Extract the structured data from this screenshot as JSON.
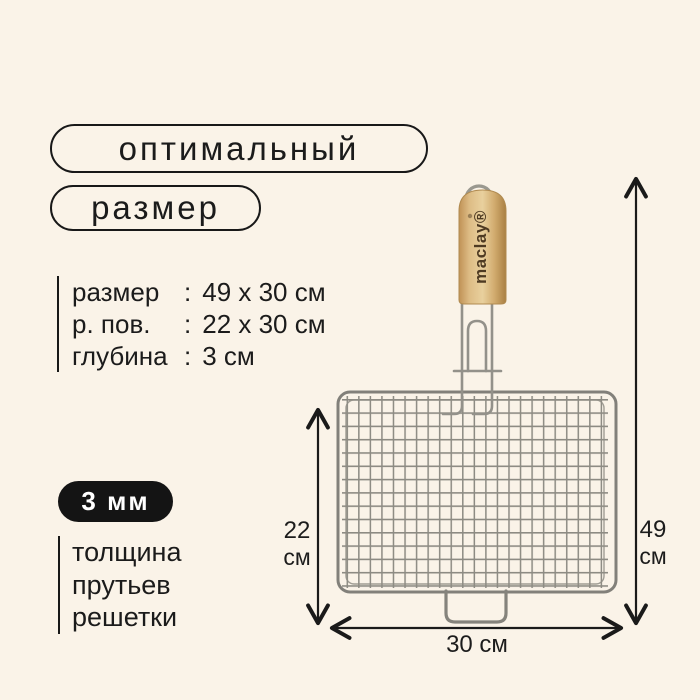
{
  "header": {
    "pill1": "оптимальный",
    "pill2": "размер"
  },
  "specs": {
    "colon": ":",
    "rows": [
      {
        "label": "размер",
        "value": "49 x 30 см"
      },
      {
        "label": "р. пов.",
        "value": "22 x 30 см"
      },
      {
        "label": "глубина",
        "value": "3 см"
      }
    ]
  },
  "thickness": {
    "badge": "3 мм",
    "lines": [
      "толщина",
      "прутьев",
      "решетки"
    ]
  },
  "product": {
    "brand": "maclay®"
  },
  "dimensions": {
    "side": {
      "value": "22",
      "unit": "см"
    },
    "total": {
      "value": "49",
      "unit": "см"
    },
    "bottom": "30 см"
  },
  "colors": {
    "background": "#faf3e8",
    "ink": "#181818",
    "badge_bg": "#141414",
    "badge_text": "#ffffff",
    "metal": "#8f8d85",
    "wood_light": "#e9d09e",
    "wood_dark": "#a97f42",
    "brand_text": "#4e3a22"
  }
}
